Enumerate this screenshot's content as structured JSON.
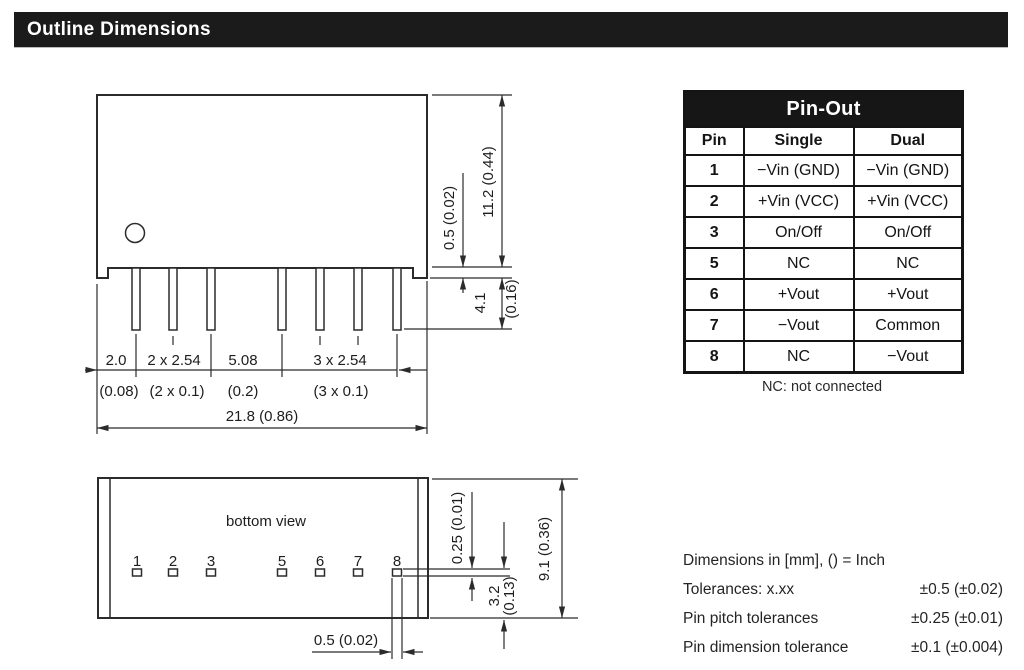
{
  "header": {
    "title": "Outline Dimensions"
  },
  "side_view": {
    "dims": {
      "pin_offset_mm": "2.0",
      "pin_offset_in": "(0.08)",
      "pitch2_mm": "2 x 2.54",
      "pitch2_in": "(2 x 0.1)",
      "gap_mm": "5.08",
      "gap_in": "(0.2)",
      "pitch3_mm": "3 x 2.54",
      "pitch3_in": "(3 x 0.1)",
      "width": "21.8  (0.86)",
      "height": "11.2  (0.44)",
      "standoff": "0.5  (0.02)",
      "pin_len_mm": "4.1",
      "pin_len_in": "(0.16)"
    }
  },
  "bottom_view": {
    "label": "bottom view",
    "pin_numbers": [
      "1",
      "2",
      "3",
      "5",
      "6",
      "7",
      "8"
    ],
    "dims": {
      "pad_thickness": "0.25 (0.01)",
      "depth": "9.1  (0.36)",
      "pad_edge_mm": "3.2",
      "pad_edge_in": "(0.13)",
      "pad_width": "0.5 (0.02)"
    }
  },
  "pinout_table": {
    "title": "Pin-Out",
    "columns": [
      "Pin",
      "Single",
      "Dual"
    ],
    "rows": [
      {
        "pin": "1",
        "single": "−Vin (GND)",
        "dual": "−Vin (GND)"
      },
      {
        "pin": "2",
        "single": "+Vin (VCC)",
        "dual": "+Vin (VCC)"
      },
      {
        "pin": "3",
        "single": "On/Off",
        "dual": "On/Off"
      },
      {
        "pin": "5",
        "single": "NC",
        "dual": "NC"
      },
      {
        "pin": "6",
        "single": "+Vout",
        "dual": "+Vout"
      },
      {
        "pin": "7",
        "single": "−Vout",
        "dual": "Common"
      },
      {
        "pin": "8",
        "single": "NC",
        "dual": "−Vout"
      }
    ],
    "footnote": "NC: not connected"
  },
  "notes": {
    "units": "Dimensions in [mm], () = Inch",
    "rows": [
      {
        "label": "Tolerances: x.xx",
        "value": "±0.5 (±0.02)"
      },
      {
        "label": "Pin pitch tolerances",
        "value": "±0.25 (±0.01)"
      },
      {
        "label": "Pin dimension tolerance",
        "value": "±0.1 (±0.004)"
      }
    ]
  }
}
